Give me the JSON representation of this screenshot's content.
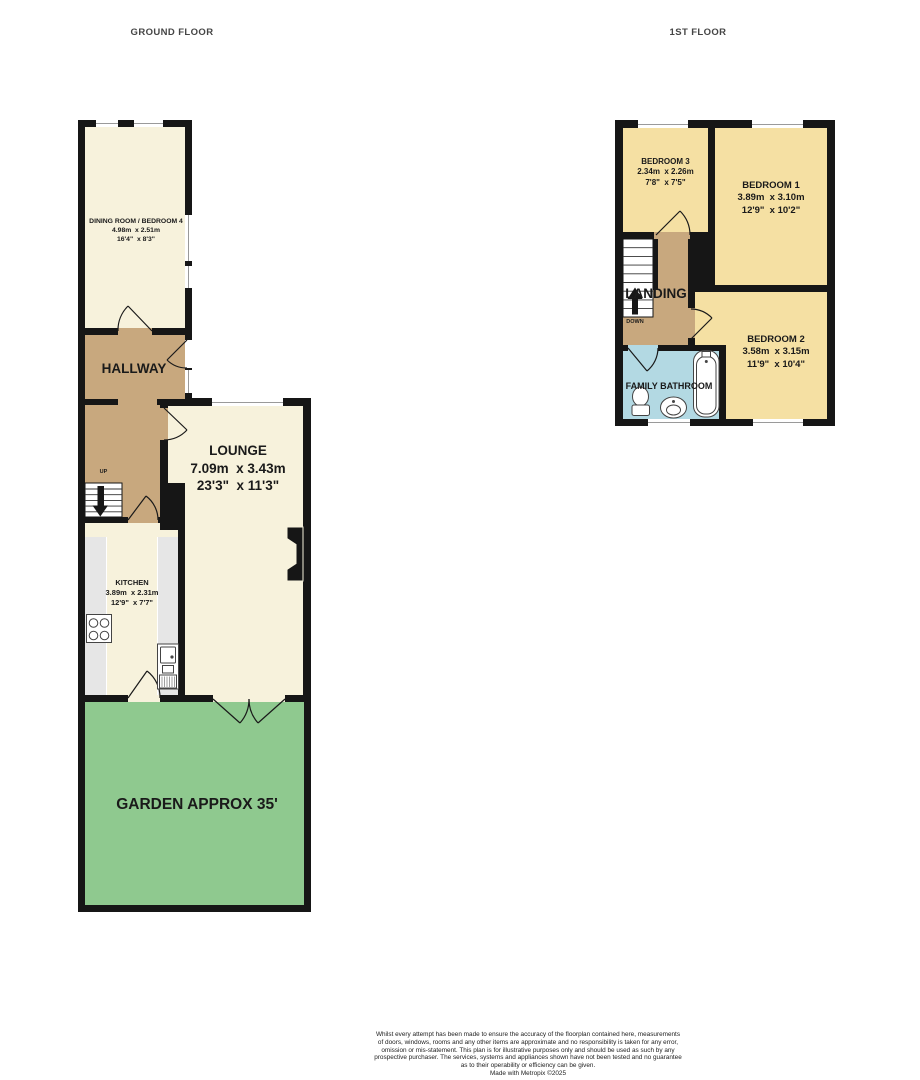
{
  "ground_floor": {
    "label": "GROUND FLOOR",
    "stair_label": "UP",
    "rooms": {
      "dining": {
        "name": "DINING ROOM / BEDROOM 4",
        "metric": "4.98m  x 2.51m",
        "imperial": "16'4\"  x 8'3\""
      },
      "hallway": {
        "name": "HALLWAY"
      },
      "lounge": {
        "name": "LOUNGE",
        "metric": "7.09m  x 3.43m",
        "imperial": "23'3\"  x 11'3\""
      },
      "kitchen": {
        "name": "KITCHEN",
        "metric": "3.89m  x 2.31m",
        "imperial": "12'9\"  x 7'7\""
      },
      "garden": {
        "name": "GARDEN APPROX 35'"
      }
    }
  },
  "first_floor": {
    "label": "1ST FLOOR",
    "stair_label": "DOWN",
    "rooms": {
      "bedroom3": {
        "name": "BEDROOM 3",
        "metric": "2.34m  x 2.26m",
        "imperial": "7'8\"  x 7'5\""
      },
      "bedroom1": {
        "name": "BEDROOM 1",
        "metric": "3.89m  x 3.10m",
        "imperial": "12'9\"  x 10'2\""
      },
      "bedroom2": {
        "name": "BEDROOM 2",
        "metric": "3.58m  x 3.15m",
        "imperial": "11'9\"  x 10'4\""
      },
      "landing": {
        "name": "LANDING"
      },
      "bathroom": {
        "name": "FAMILY BATHROOM"
      }
    }
  },
  "footer": {
    "lines": [
      "Whilst every attempt has been made to ensure the accuracy of the floorplan contained here, measurements",
      "of doors, windows, rooms and any other items are approximate and no responsibility is taken for any error,",
      "omission or mis-statement. This plan is for illustrative purposes only and should be used as such by any",
      "prospective purchaser. The services, systems and appliances shown have not been tested and no guarantee",
      "as to their operability or efficiency can be given.",
      "Made with Metropix ©2025"
    ]
  },
  "colors": {
    "wall": "#161616",
    "cream": "#F7F2DC",
    "tan": "#C8A87E",
    "yellow": "#F5E0A3",
    "blue": "#B3D9E3",
    "green": "#8FC98F",
    "counter": "#E6E6E6",
    "label": "#1A1A1A",
    "floor_label": "#454545",
    "footer_text": "#222222"
  }
}
